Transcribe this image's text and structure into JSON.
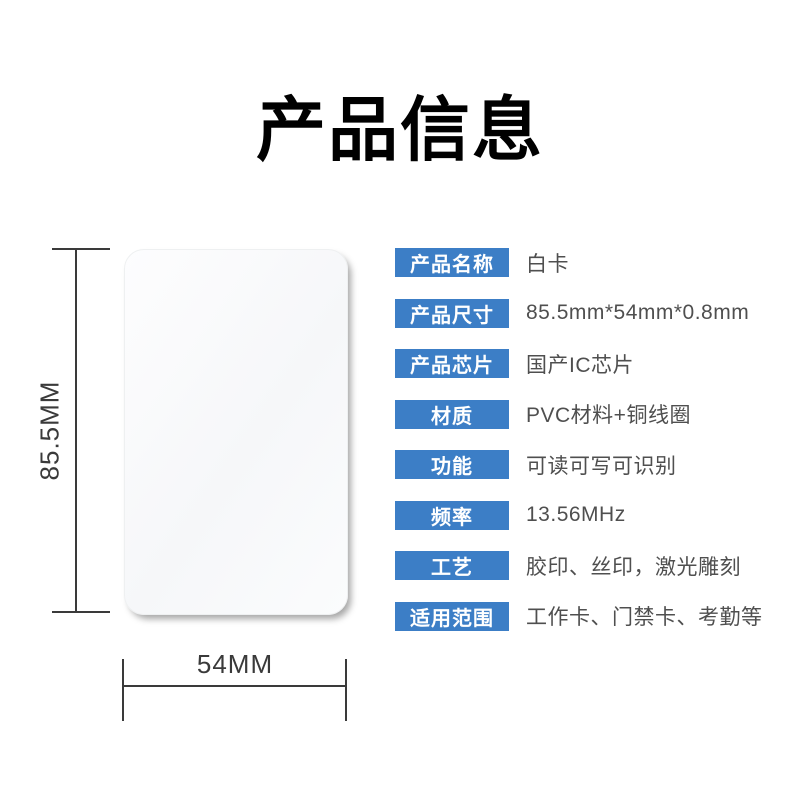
{
  "page": {
    "title": "产品信息",
    "background_color": "#ffffff"
  },
  "colors": {
    "badge_blue": "#3c7ec6",
    "value_text": "#4f4f4f",
    "dimension_line": "#3a3a3a",
    "title_text": "#000000"
  },
  "card_figure": {
    "description": "blank white PVC card, rounded corners",
    "height_label": "85.5MM",
    "width_label": "54MM"
  },
  "specs": [
    {
      "label": "产品名称",
      "value": "白卡"
    },
    {
      "label": "产品尺寸",
      "value": "85.5mm*54mm*0.8mm"
    },
    {
      "label": "产品芯片",
      "value": "国产IC芯片"
    },
    {
      "label": "材质",
      "value": "PVC材料+铜线圈"
    },
    {
      "label": "功能",
      "value": "可读可写可识别"
    },
    {
      "label": "频率",
      "value": "13.56MHz"
    },
    {
      "label": "工艺",
      "value": "胶印、丝印，激光雕刻"
    },
    {
      "label": "适用范围",
      "value": "工作卡、门禁卡、考勤等"
    }
  ]
}
